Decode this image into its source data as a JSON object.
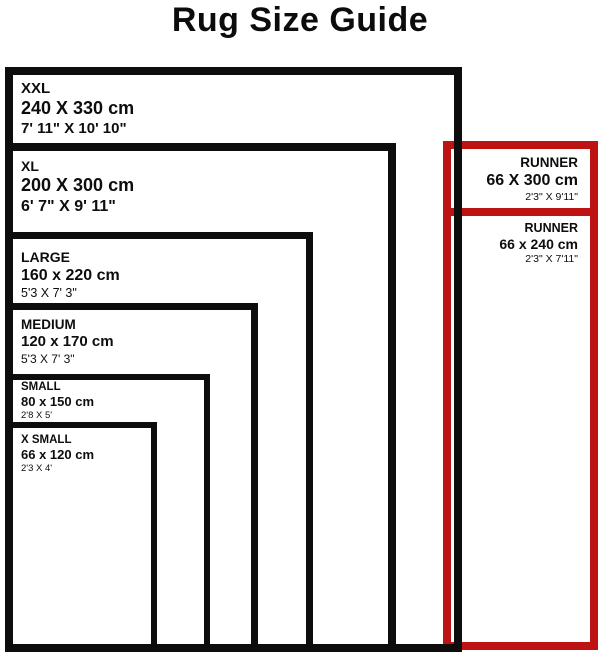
{
  "title": "Rug Size Guide",
  "colors": {
    "outline_black": "#0d0d0d",
    "runner_red": "#be1313",
    "background": "#ffffff"
  },
  "rugs": [
    {
      "name": "XXL",
      "cm": "240 X 330 cm",
      "ft": "7' 11\" X 10' 10\""
    },
    {
      "name": "XL",
      "cm": "200 X 300 cm",
      "ft": "6' 7\" X 9' 11\""
    },
    {
      "name": "LARGE",
      "cm": "160 x 220 cm",
      "ft": "5'3 X 7' 3\""
    },
    {
      "name": "MEDIUM",
      "cm": "120 x 170 cm",
      "ft": "5'3 X 7' 3\""
    },
    {
      "name": "SMALL",
      "cm": "80 x 150 cm",
      "ft": "2'8 X 5'"
    },
    {
      "name": "X SMALL",
      "cm": "66 x 120 cm",
      "ft": "2'3 X 4'"
    }
  ],
  "runners": [
    {
      "name": "RUNNER",
      "cm": "66 X 300 cm",
      "ft": "2'3\" X 9'11\""
    },
    {
      "name": "RUNNER",
      "cm": "66 x 240 cm",
      "ft": "2'3\" X 7'11\""
    }
  ]
}
